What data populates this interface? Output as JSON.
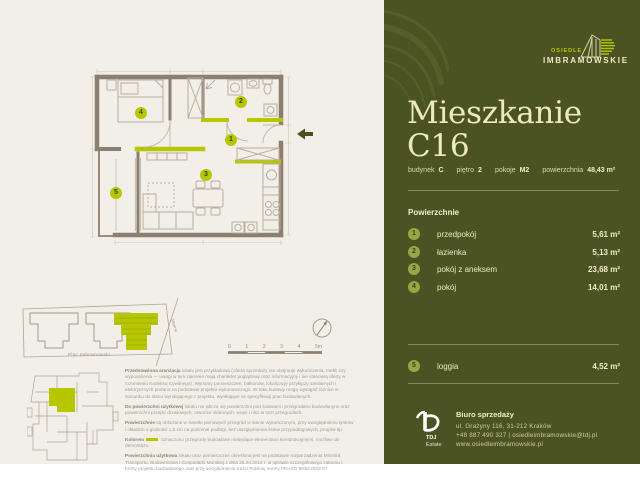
{
  "colors": {
    "accent": "#b6c700",
    "panel": "#4b5323",
    "cream": "#f1efe8"
  },
  "logo": {
    "small": "OSIEDLE",
    "large": "IMBRAMOWSKIE"
  },
  "title": "Mieszkanie C16",
  "details": [
    {
      "label": "budynek",
      "value": "C"
    },
    {
      "label": "piętro",
      "value": "2"
    },
    {
      "label": "pokoje",
      "value": "M2"
    },
    {
      "label": "powierzchnia",
      "value": "48,43 m²"
    }
  ],
  "areas": {
    "heading": "Powierzchnie",
    "rooms": [
      {
        "num": "1",
        "label": "przedpokój",
        "area": "5,61 m²"
      },
      {
        "num": "2",
        "label": "łazienka",
        "area": "5,13 m²"
      },
      {
        "num": "3",
        "label": "pokój z aneksem",
        "area": "23,68 m²"
      },
      {
        "num": "4",
        "label": "pokój",
        "area": "14,01 m²"
      },
      {
        "num": "5",
        "label": "loggia",
        "area": "4,52 m²"
      }
    ]
  },
  "plan": {
    "circles": [
      "1",
      "2",
      "3",
      "4",
      "5"
    ],
    "scale_labels": [
      "0",
      "1",
      "2",
      "3",
      "4",
      "5m"
    ]
  },
  "siteplan": {
    "place": "Plac Imbramowski",
    "street": "Siewna"
  },
  "disclaimer": {
    "paragraphs": [
      {
        "lead": "Przedstawiona aranżacja",
        "text": " lokalu jest przykładowa (oferta sprzedaży nie obejmuje wykończenia, mebli czy wyposażenia — uwagi w tym zakresie mają charakter poglądowy oraz informacyjny i nie stanowią oferty w rozumieniu Kodeksu Cywilnego). Wymiary pomieszczeń, balkonów, lokalizację przyłączy sanitarnych i elektrycznych podano na podstawie projektu wykonawczego. W toku budowy mogą wystąpić różnice w stosunku do stanu wynikającego z projektu, wynikające ze specyfikacji prac budowlanych."
      },
      {
        "lead": "Do powierzchni użytkowej",
        "text": " lokalu nie wlicza się powierzchni pod ścianami i przegrodami budowlanymi oraz powierzchni przejść drzwiowych, otworów okiennych, wnęk i nisz w tych przegrodach."
      },
      {
        "lead": "Powierzchnie",
        "text": " są obliczane w świetle pionowych przegród w stanie wykończonym, przy uwzględnieniu tynków i okładzin o grubości 1,5 cm na poziomie podłogi, bez uwzględnienia listew przypodłogowych, progów itp."
      },
      {
        "lead": "Kolorem",
        "swatch": true,
        "text": " oznaczono przegrody budowlane niebędące elementami konstrukcyjnymi, możliwe do demontażu."
      },
      {
        "lead": "Powierzchnia użytkowa",
        "text": " lokalu oraz pomieszczeń określona jest na podstawie rozporządzenia Ministra Transportu, Budownictwa i Gospodarki Morskiej z dnia 25.04.2012 r. w sprawie szczegółowego zakresu i formy projektu budowlanego oraz przy uwzględnieniu treści Polskiej normy PN-ISO 9836:2022-07."
      }
    ]
  },
  "contact": {
    "heading": "Biuro sprzedaży",
    "address": "ul. Grażyny 116, 31-212 Kraków",
    "phone": "+48 887 490 327",
    "separator": " | ",
    "email": "osiedleimbramowskie@tdj.pl",
    "website": "www.osiedleimbramowskie.pl",
    "brand_line1": "TDJ",
    "brand_line2": "Estate"
  }
}
